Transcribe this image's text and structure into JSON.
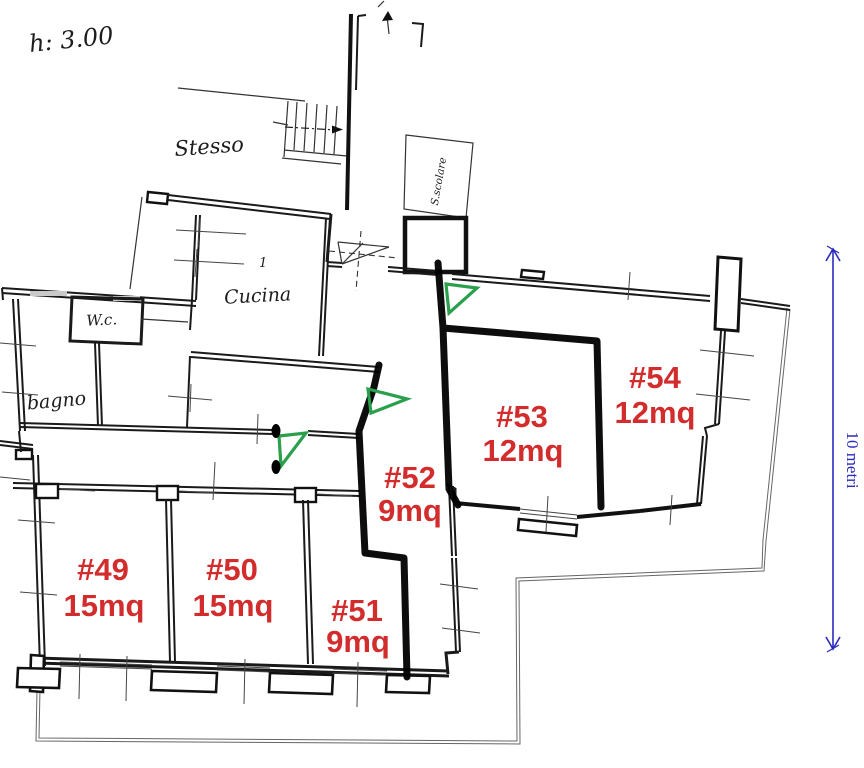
{
  "document": {
    "type": "scanned apartment floor plan with room annotations"
  },
  "annotations": {
    "ceiling_height": "h: 3.00",
    "stairwell": "Stesso",
    "stair_shaft": "S.scolare",
    "kitchen": "Cucina",
    "wc": "W.c.",
    "bathroom": "bagno",
    "kitchen_mark": "1"
  },
  "rooms": [
    {
      "id": "#49",
      "area": "15mq"
    },
    {
      "id": "#50",
      "area": "15mq"
    },
    {
      "id": "#51",
      "area": "9mq"
    },
    {
      "id": "#52",
      "area": "9mq"
    },
    {
      "id": "#53",
      "area": "12mq"
    },
    {
      "id": "#54",
      "area": "12mq"
    }
  ],
  "dimension": {
    "label": "10 metri"
  },
  "colors": {
    "room_label": "#d22c2c",
    "door_marker": "#2aa04d",
    "dimension_line": "#2b2bbd",
    "walls": "#1a1a1a"
  },
  "icons": [
    "up-arrow-icon",
    "stair-direction-arrow-icon",
    "door-swing-icon",
    "entrance-door-icon",
    "dimension-arrow-icon"
  ]
}
